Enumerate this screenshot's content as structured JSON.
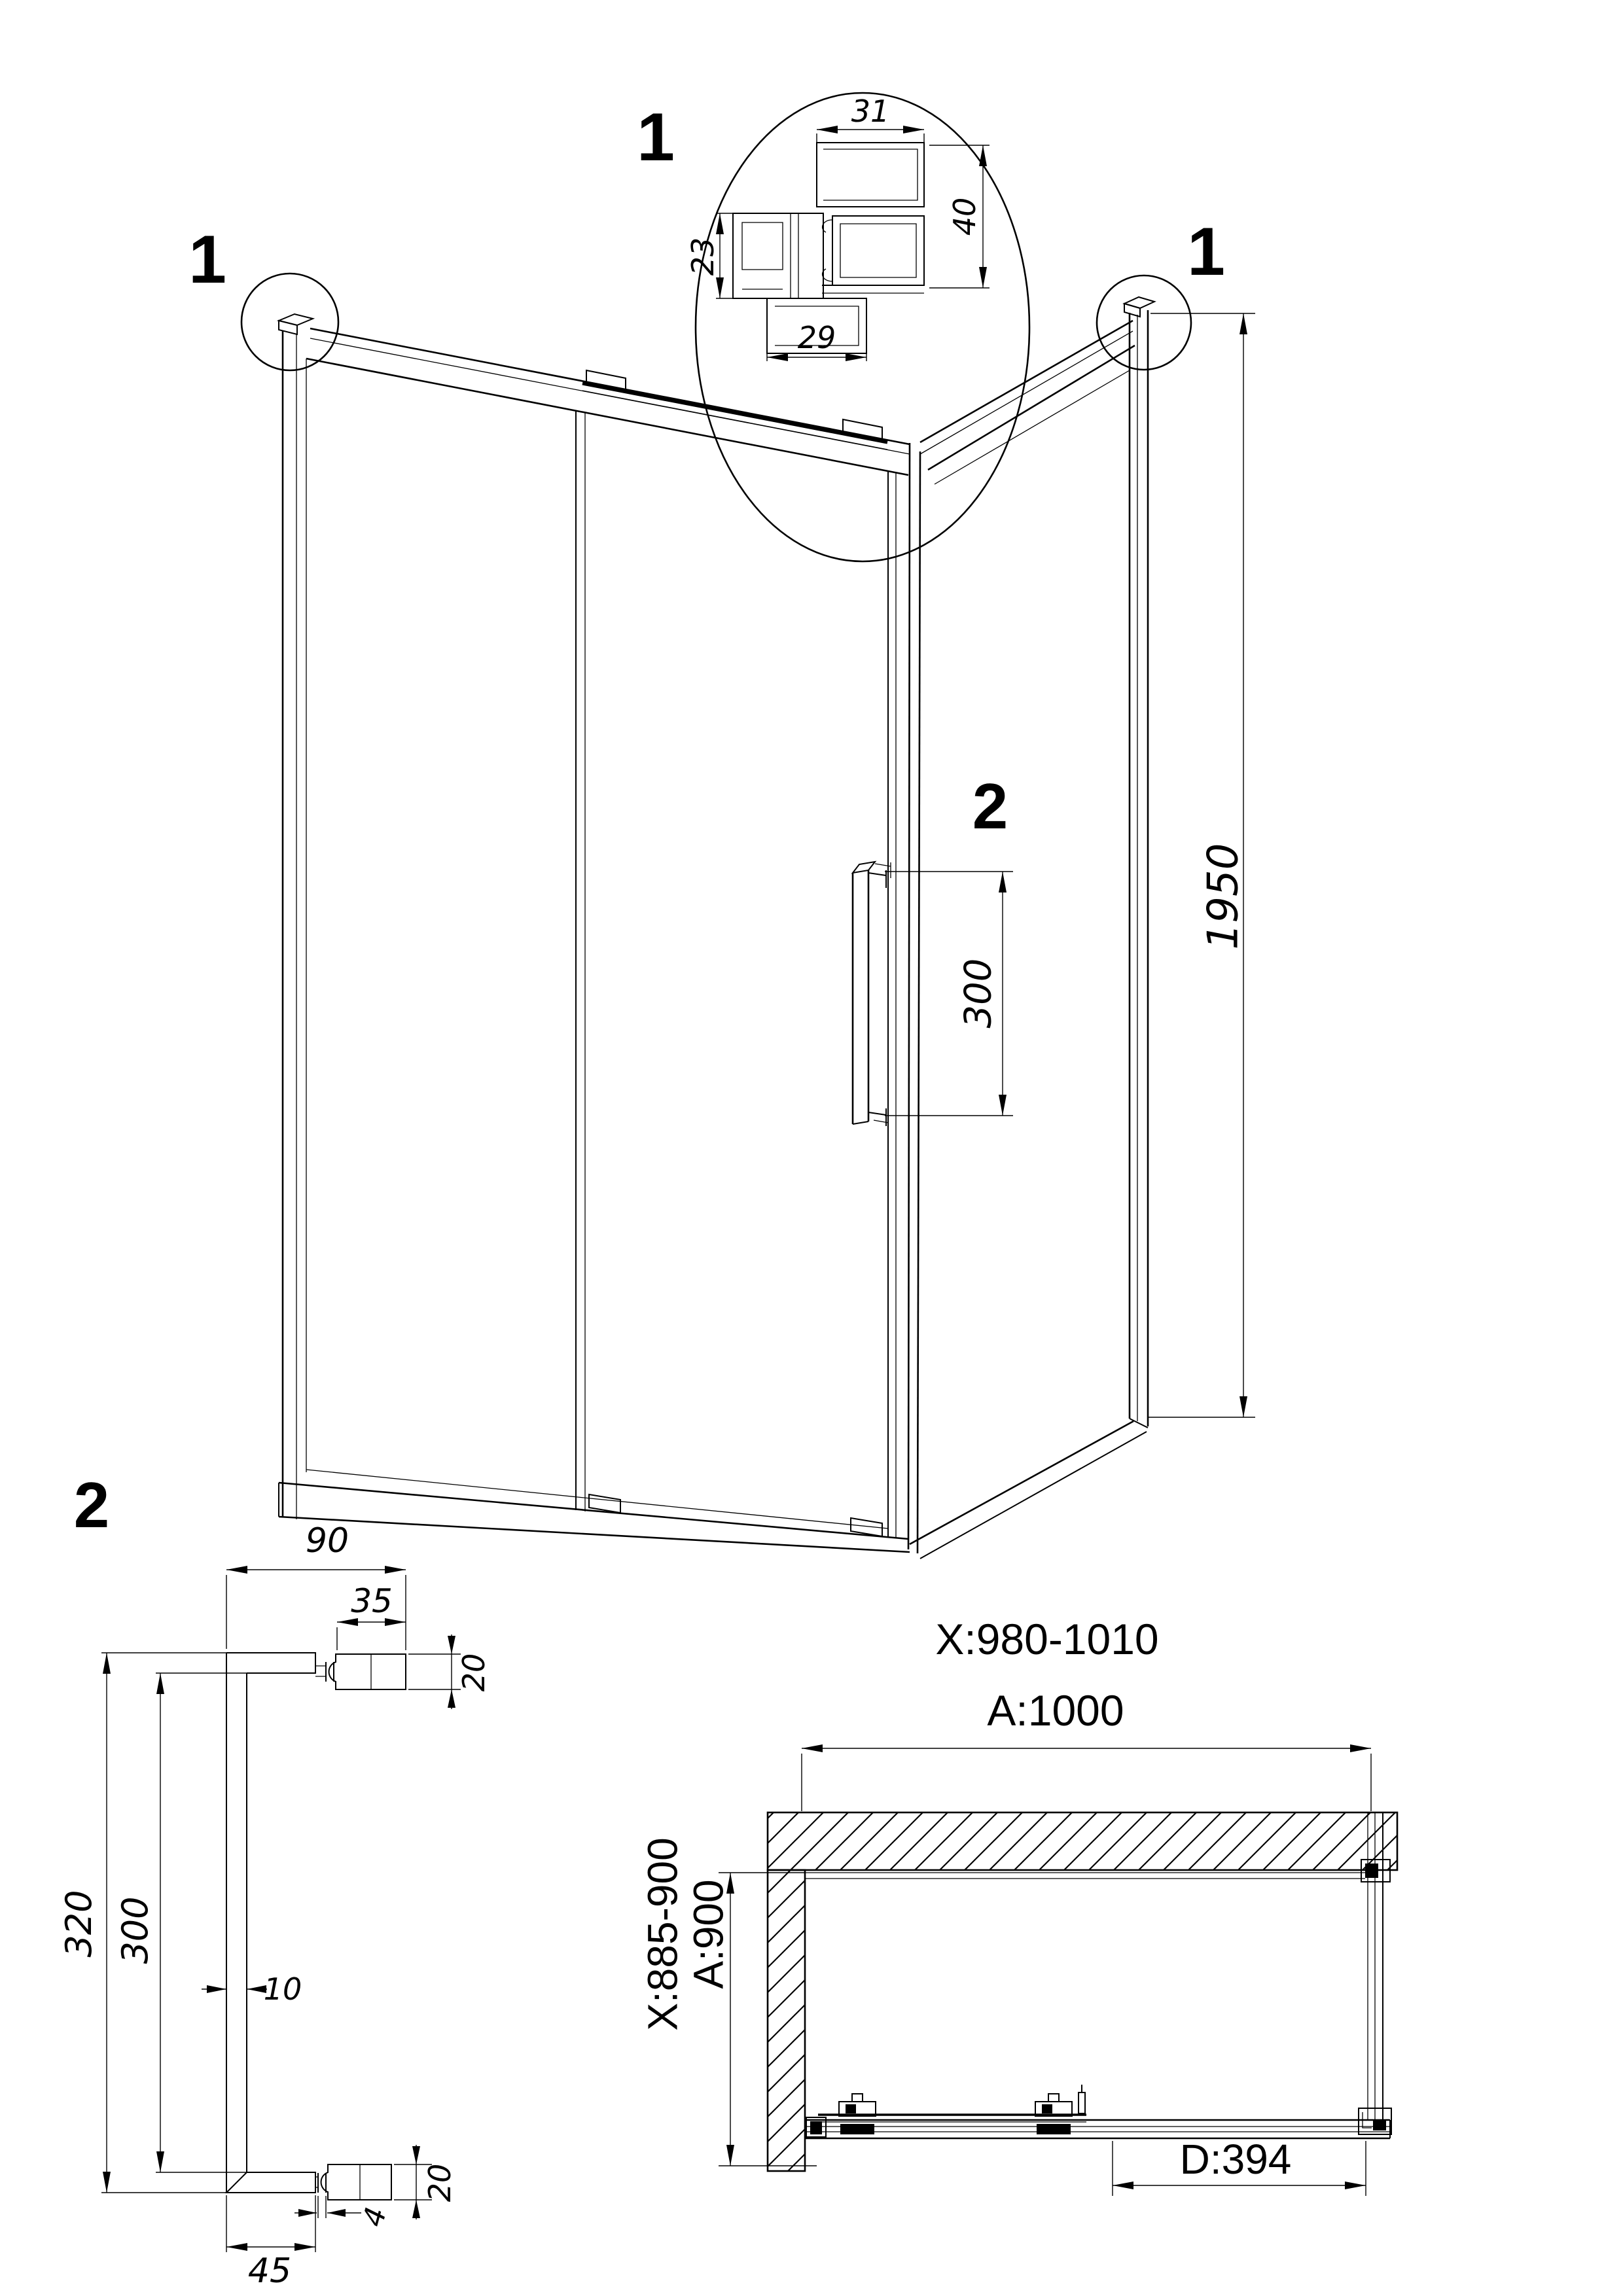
{
  "callouts": {
    "corner_left": "1",
    "corner_right": "1",
    "profile_detail": "1",
    "handle_main": "2",
    "handle_detail": "2"
  },
  "main_view": {
    "height_dim": "1950",
    "handle_grip_dim": "300"
  },
  "profile_detail": {
    "top_width": "31",
    "left_height": "23",
    "bottom_width": "29",
    "right_height": "40"
  },
  "handle_detail": {
    "total_width": "90",
    "knob_width": "35",
    "knob_thickness_top": "20",
    "overall_height": "320",
    "grip_length": "300",
    "bar_thickness": "10",
    "knob_thickness_bottom": "20",
    "stem_width": "4",
    "arm_length": "45"
  },
  "plan_view": {
    "width_adjust_range": "X:980-1010",
    "width_nominal": "A:1000",
    "depth_adjust_range": "X:885-900",
    "depth_nominal": "A:900",
    "door_opening": "D:394"
  }
}
